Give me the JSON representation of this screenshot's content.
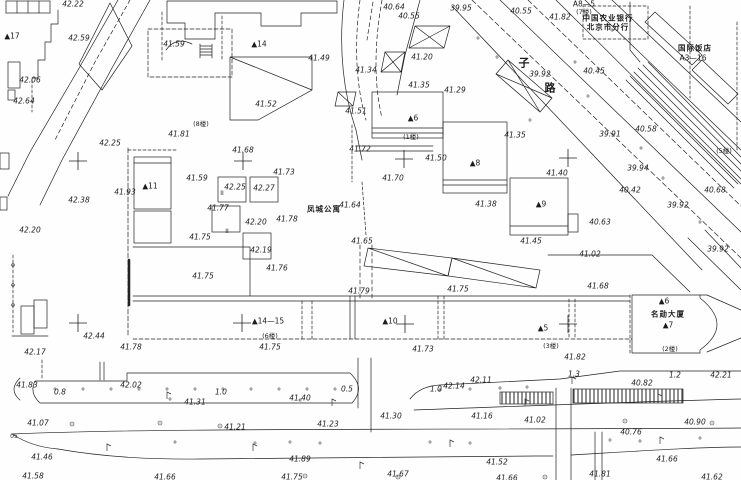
{
  "drawing": {
    "kind": "cadastral-survey-site-plan",
    "line_color": "#222222",
    "background": "#fefefe"
  },
  "labels": {
    "elevations": [
      {
        "t": "42.22",
        "x": 73,
        "y": 4
      },
      {
        "t": "42.59",
        "x": 79,
        "y": 38
      },
      {
        "t": "41.59",
        "x": 174,
        "y": 44
      },
      {
        "t": "42.06",
        "x": 30,
        "y": 80
      },
      {
        "t": "42.64",
        "x": 24,
        "y": 101
      },
      {
        "t": "40.64",
        "x": 394,
        "y": 7
      },
      {
        "t": "40.55",
        "x": 409,
        "y": 16
      },
      {
        "t": "39.95",
        "x": 461,
        "y": 8
      },
      {
        "t": "40.55",
        "x": 521,
        "y": 11
      },
      {
        "t": "41.82",
        "x": 560,
        "y": 17
      },
      {
        "t": "41.49",
        "x": 319,
        "y": 58
      },
      {
        "t": "41.20",
        "x": 422,
        "y": 57
      },
      {
        "t": "41.34",
        "x": 366,
        "y": 70
      },
      {
        "t": "41.35",
        "x": 419,
        "y": 85
      },
      {
        "t": "41.29",
        "x": 455,
        "y": 90
      },
      {
        "t": "41.52",
        "x": 266,
        "y": 104
      },
      {
        "t": "41.51",
        "x": 356,
        "y": 111
      },
      {
        "t": "39.92",
        "x": 540,
        "y": 74
      },
      {
        "t": "40.45",
        "x": 594,
        "y": 71
      },
      {
        "t": "42.25",
        "x": 110,
        "y": 143
      },
      {
        "t": "41.81",
        "x": 179,
        "y": 134
      },
      {
        "t": "41.68",
        "x": 243,
        "y": 150
      },
      {
        "t": "42.25",
        "x": 235,
        "y": 187
      },
      {
        "t": "42.27",
        "x": 264,
        "y": 188
      },
      {
        "t": "41.73",
        "x": 284,
        "y": 172
      },
      {
        "t": "41.59",
        "x": 197,
        "y": 178
      },
      {
        "t": "41.93",
        "x": 125,
        "y": 192
      },
      {
        "t": "42.38",
        "x": 79,
        "y": 200
      },
      {
        "t": "41.77",
        "x": 218,
        "y": 208
      },
      {
        "t": "42.20",
        "x": 30,
        "y": 230
      },
      {
        "t": "42.20",
        "x": 256,
        "y": 222
      },
      {
        "t": "41.75",
        "x": 200,
        "y": 237
      },
      {
        "t": "41.78",
        "x": 287,
        "y": 219
      },
      {
        "t": "41.64",
        "x": 350,
        "y": 205
      },
      {
        "t": "41.72",
        "x": 360,
        "y": 149
      },
      {
        "t": "41.50",
        "x": 436,
        "y": 158
      },
      {
        "t": "41.70",
        "x": 393,
        "y": 178
      },
      {
        "t": "41.38",
        "x": 486,
        "y": 204
      },
      {
        "t": "41.35",
        "x": 515,
        "y": 135
      },
      {
        "t": "41.40",
        "x": 557,
        "y": 173
      },
      {
        "t": "41.45",
        "x": 531,
        "y": 241
      },
      {
        "t": "41.65",
        "x": 362,
        "y": 241
      },
      {
        "t": "40.58",
        "x": 646,
        "y": 129
      },
      {
        "t": "39.91",
        "x": 610,
        "y": 134
      },
      {
        "t": "39.94",
        "x": 638,
        "y": 168
      },
      {
        "t": "40.42",
        "x": 630,
        "y": 190
      },
      {
        "t": "40.68",
        "x": 715,
        "y": 190
      },
      {
        "t": "39.92",
        "x": 678,
        "y": 205
      },
      {
        "t": "40.63",
        "x": 600,
        "y": 222
      },
      {
        "t": "39.92",
        "x": 718,
        "y": 249
      },
      {
        "t": "41.75",
        "x": 203,
        "y": 276
      },
      {
        "t": "42.44",
        "x": 94,
        "y": 336
      },
      {
        "t": "42.17",
        "x": 35,
        "y": 352
      },
      {
        "t": "41.78",
        "x": 131,
        "y": 347
      },
      {
        "t": "42.19",
        "x": 261,
        "y": 250
      },
      {
        "t": "41.76",
        "x": 277,
        "y": 268
      },
      {
        "t": "41.79",
        "x": 359,
        "y": 291
      },
      {
        "t": "41.75",
        "x": 458,
        "y": 289
      },
      {
        "t": "41.02",
        "x": 590,
        "y": 254
      },
      {
        "t": "41.68",
        "x": 598,
        "y": 286
      },
      {
        "t": "41.75",
        "x": 270,
        "y": 347
      },
      {
        "t": "41.73",
        "x": 423,
        "y": 349
      },
      {
        "t": "41.82",
        "x": 575,
        "y": 357
      },
      {
        "t": "41.83",
        "x": 27,
        "y": 385
      },
      {
        "t": "42.02",
        "x": 131,
        "y": 385
      },
      {
        "t": "41.31",
        "x": 195,
        "y": 402
      },
      {
        "t": "41.07",
        "x": 38,
        "y": 423
      },
      {
        "t": "41.21",
        "x": 235,
        "y": 427
      },
      {
        "t": "41.40",
        "x": 300,
        "y": 398
      },
      {
        "t": "42.14",
        "x": 454,
        "y": 386
      },
      {
        "t": "42.11",
        "x": 481,
        "y": 380
      },
      {
        "t": "41.30",
        "x": 391,
        "y": 416
      },
      {
        "t": "41.16",
        "x": 482,
        "y": 416
      },
      {
        "t": "41.23",
        "x": 328,
        "y": 424
      },
      {
        "t": "42.21",
        "x": 721,
        "y": 375
      },
      {
        "t": "40.82",
        "x": 642,
        "y": 383
      },
      {
        "t": "41.02",
        "x": 535,
        "y": 420
      },
      {
        "t": "40.90",
        "x": 695,
        "y": 422
      },
      {
        "t": "40.76",
        "x": 631,
        "y": 432
      },
      {
        "t": "41.46",
        "x": 42,
        "y": 457
      },
      {
        "t": "41.89",
        "x": 300,
        "y": 459
      },
      {
        "t": "41.52",
        "x": 497,
        "y": 462
      },
      {
        "t": "41.66",
        "x": 667,
        "y": 459
      },
      {
        "t": "41.58",
        "x": 33,
        "y": 476
      },
      {
        "t": "41.66",
        "x": 165,
        "y": 477
      },
      {
        "t": "41.75",
        "x": 292,
        "y": 477
      },
      {
        "t": "41.67",
        "x": 398,
        "y": 474
      },
      {
        "t": "41.66",
        "x": 507,
        "y": 478
      },
      {
        "t": "41.81",
        "x": 600,
        "y": 474
      },
      {
        "t": "41.62",
        "x": 712,
        "y": 477
      }
    ],
    "building_numbers": [
      {
        "t": "▲17",
        "x": 12,
        "y": 36
      },
      {
        "t": "▲14",
        "x": 259,
        "y": 44
      },
      {
        "t": "▲11",
        "x": 150,
        "y": 186
      },
      {
        "t": "▲6",
        "x": 413,
        "y": 118
      },
      {
        "t": "▲8",
        "x": 475,
        "y": 163
      },
      {
        "t": "▲9",
        "x": 541,
        "y": 204
      },
      {
        "t": "▲10",
        "x": 390,
        "y": 321
      },
      {
        "t": "▲14—15",
        "x": 268,
        "y": 321
      },
      {
        "t": "▲5",
        "x": 543,
        "y": 328
      },
      {
        "t": "▲6",
        "x": 664,
        "y": 301
      },
      {
        "t": "▲7",
        "x": 668,
        "y": 325
      },
      {
        "t": "A8—5",
        "x": 584,
        "y": 4
      },
      {
        "t": "A3—16",
        "x": 693,
        "y": 58
      }
    ],
    "floor_tags": [
      {
        "t": "(8楼)",
        "x": 201,
        "y": 124
      },
      {
        "t": "(1楼)",
        "x": 411,
        "y": 137
      },
      {
        "t": "(7楼)",
        "x": 584,
        "y": 12
      },
      {
        "t": "(5楼)",
        "x": 724,
        "y": 151
      },
      {
        "t": "(6楼)",
        "x": 270,
        "y": 336
      },
      {
        "t": "(3楼)",
        "x": 551,
        "y": 346
      },
      {
        "t": "(2楼)",
        "x": 670,
        "y": 349
      }
    ],
    "names": [
      {
        "t": "中国农业银行",
        "x": 608,
        "y": 18
      },
      {
        "t": "北京市分行",
        "x": 608,
        "y": 27
      },
      {
        "t": "国际饭店",
        "x": 695,
        "y": 48
      },
      {
        "t": "凤城公寓",
        "x": 324,
        "y": 209
      },
      {
        "t": "名勋大厦",
        "x": 668,
        "y": 314
      }
    ],
    "road_widths": [
      {
        "t": "0.8",
        "x": 60,
        "y": 392
      },
      {
        "t": "1.0",
        "x": 221,
        "y": 392
      },
      {
        "t": "0.5",
        "x": 347,
        "y": 389
      },
      {
        "t": "1.0",
        "x": 436,
        "y": 389
      },
      {
        "t": "1.3",
        "x": 574,
        "y": 374
      },
      {
        "t": "1.2",
        "x": 675,
        "y": 375
      }
    ],
    "road_chars": [
      {
        "t": "子",
        "x": 524,
        "y": 63
      },
      {
        "t": "路",
        "x": 550,
        "y": 88
      }
    ],
    "misc": [
      {
        "t": "II",
        "x": 222,
        "y": 194
      },
      {
        "t": "II",
        "x": 227,
        "y": 232
      },
      {
        "t": "05",
        "x": 14,
        "y": 437
      }
    ]
  },
  "crosses": [
    [
      78,
      161
    ],
    [
      243,
      161
    ],
    [
      404,
      159
    ],
    [
      568,
      158
    ],
    [
      78,
      323
    ],
    [
      242,
      323
    ],
    [
      405,
      324
    ],
    [
      568,
      324
    ]
  ]
}
